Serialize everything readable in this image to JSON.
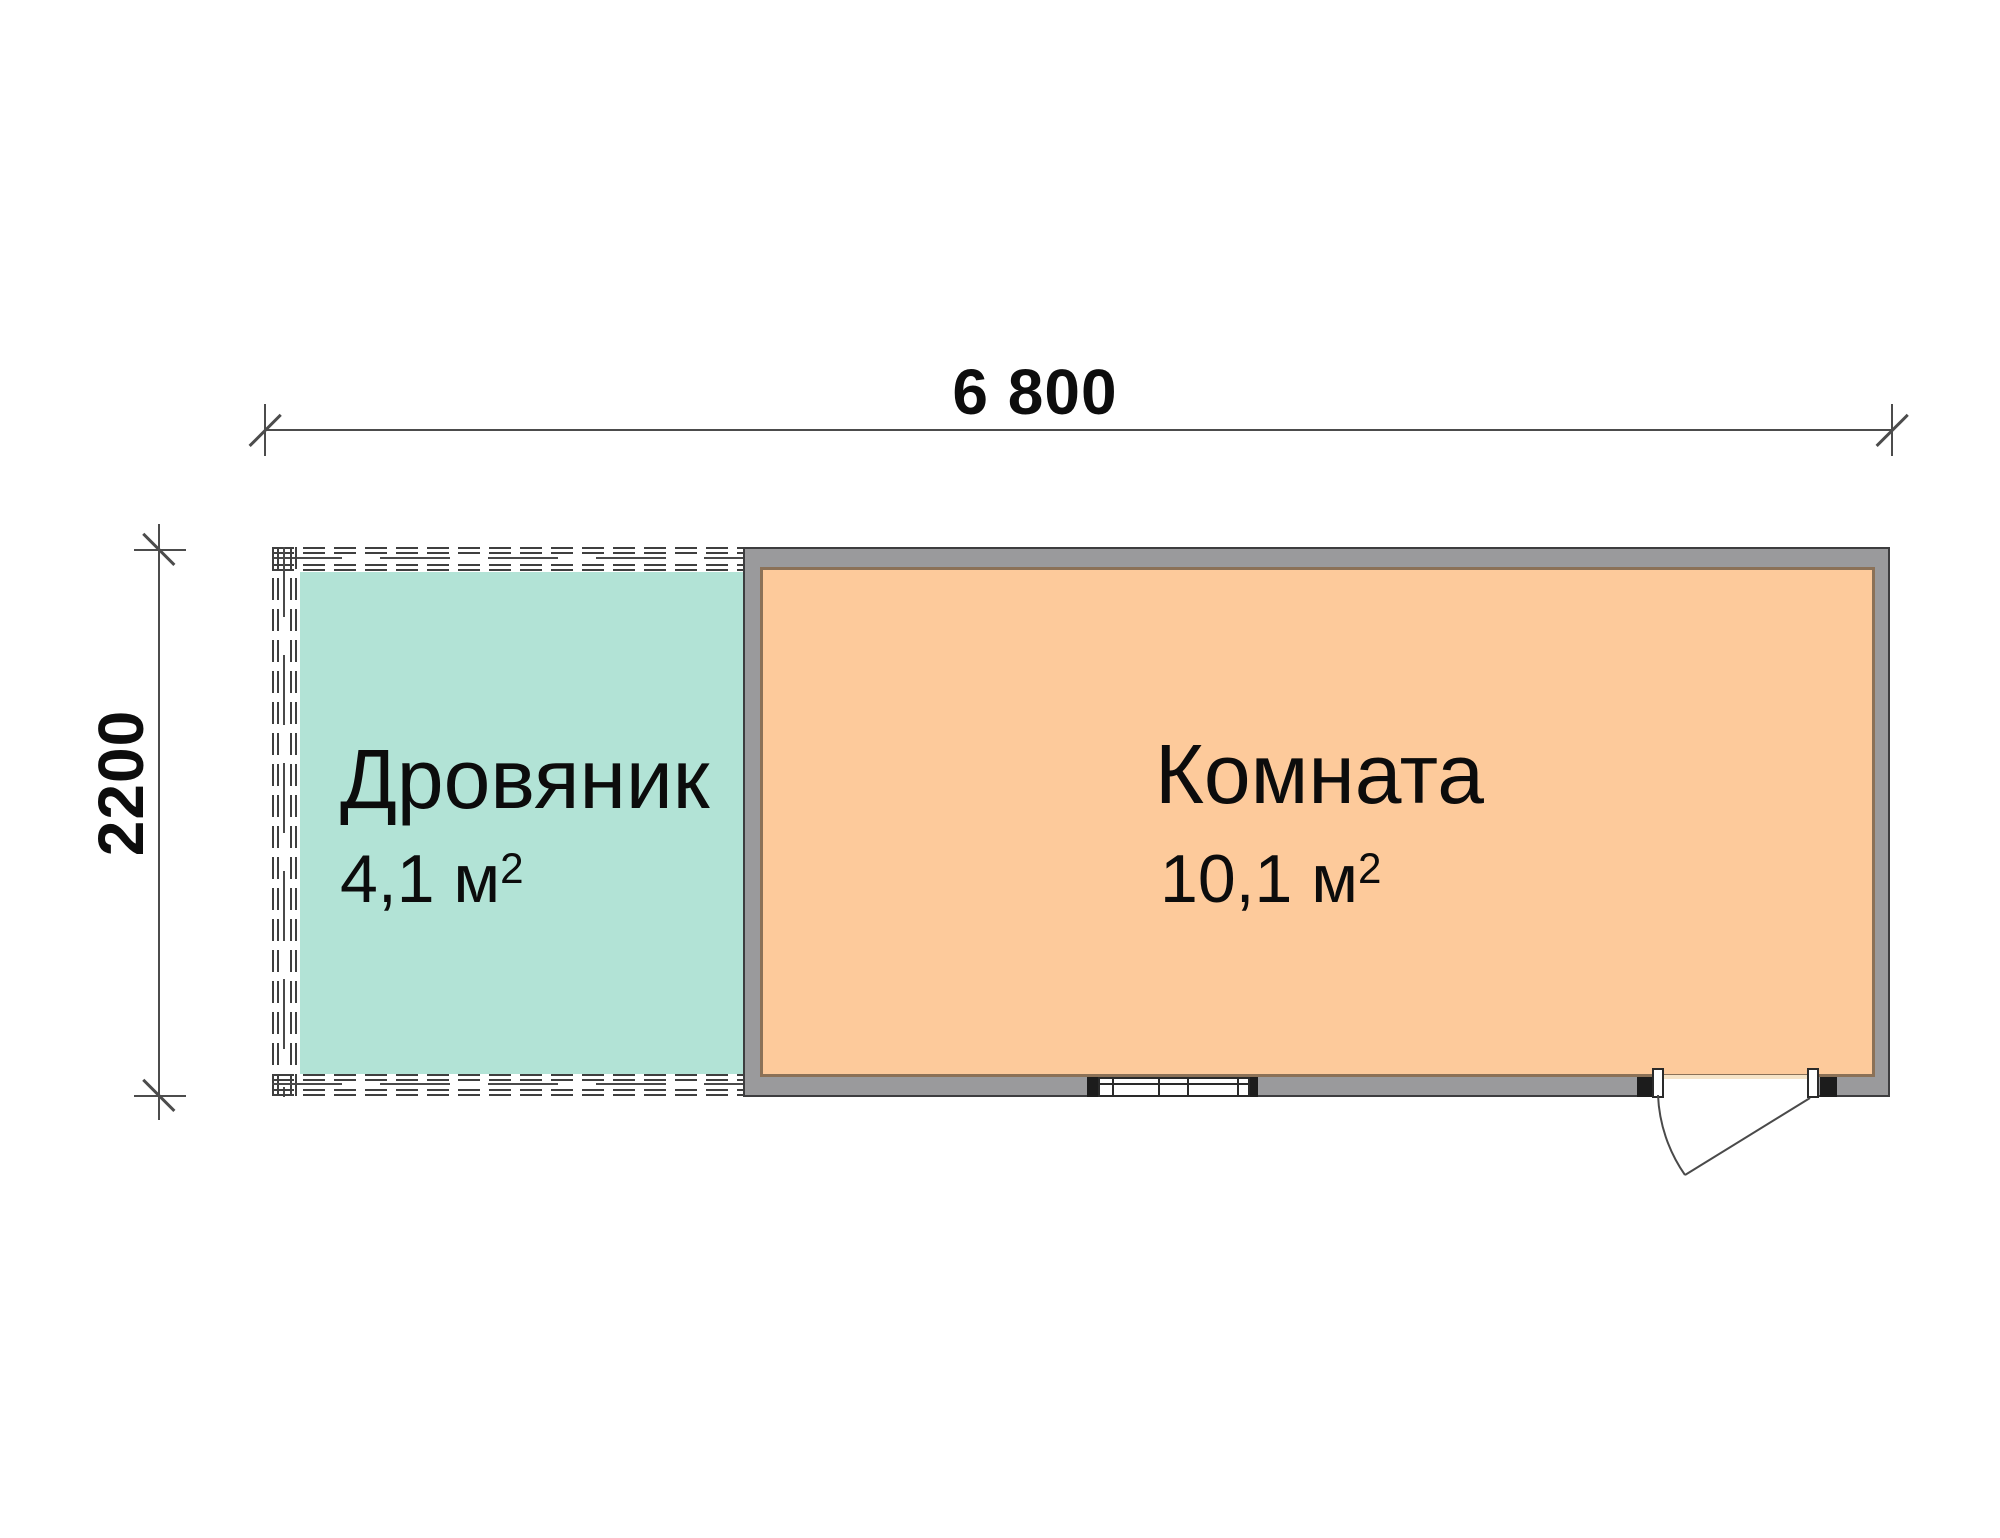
{
  "plan": {
    "dimensions": {
      "width_label": "6 800",
      "height_label": "2200"
    },
    "rooms": [
      {
        "name": "Дровяник",
        "area": "4,1 м",
        "area_sup": "2",
        "fill": "#b2e3d6"
      },
      {
        "name": "Комната",
        "area": "10,1 м",
        "area_sup": "2",
        "fill": "#fdca9b"
      }
    ],
    "colors": {
      "wall_gray": "#9a9a9c",
      "wall_outline": "#3d3d3f",
      "interior_trim": "#8b7157",
      "lattice_dash": "#3f3f3f",
      "dimension_line": "#4c4c4c",
      "room1_fill": "#b2e3d6",
      "room2_fill": "#fdca9b"
    }
  }
}
